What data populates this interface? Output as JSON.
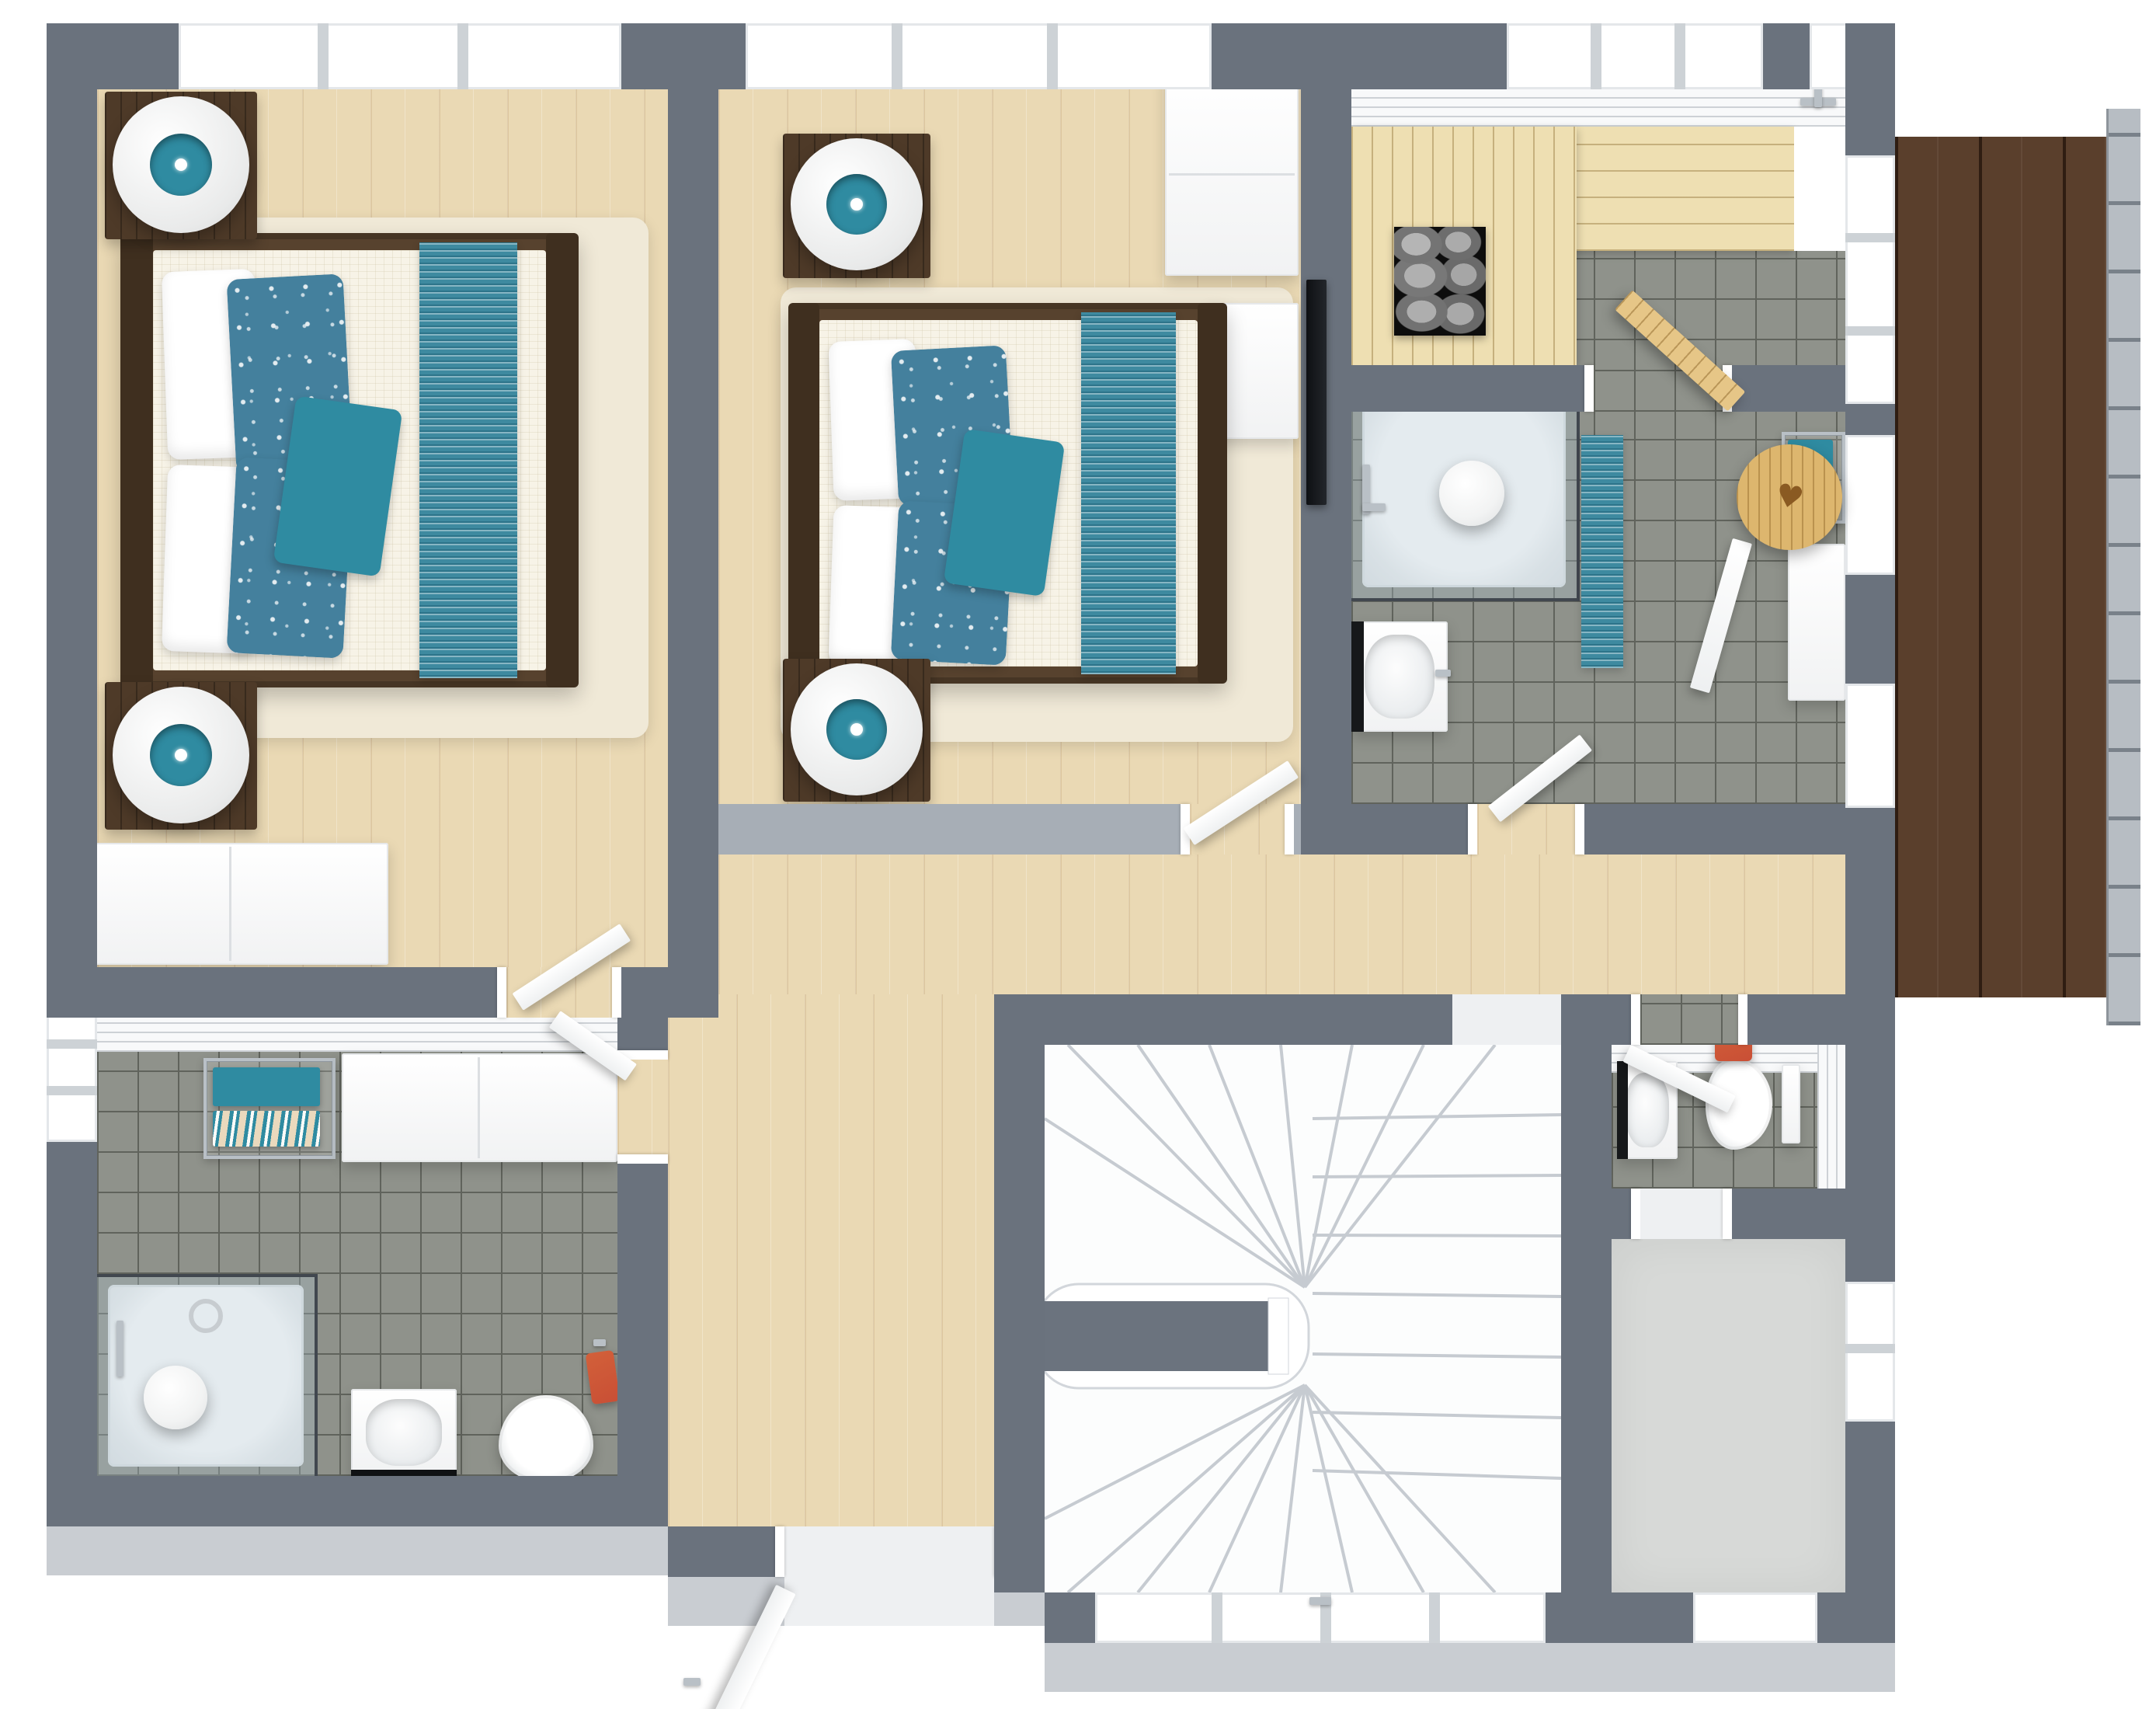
{
  "rooms": [
    {
      "id": "bedroom-1",
      "name": "Bedroom 1"
    },
    {
      "id": "bedroom-2",
      "name": "Bedroom 2"
    },
    {
      "id": "hallway",
      "name": "Hallway / Landing"
    },
    {
      "id": "bathroom-left",
      "name": "Bathroom with shower and laundry"
    },
    {
      "id": "sauna",
      "name": "Sauna"
    },
    {
      "id": "bathroom-top",
      "name": "Shower bathroom"
    },
    {
      "id": "wc",
      "name": "WC"
    },
    {
      "id": "storage",
      "name": "Walk-in closet / Storage"
    },
    {
      "id": "staircase",
      "name": "Winder staircase"
    },
    {
      "id": "balcony",
      "name": "Balcony terrace"
    }
  ],
  "furniture": {
    "double_bed": "Double bed with white duvet and teal runner",
    "mattress": "Mattress with white duvet",
    "pillow": "White pillow",
    "floral_pillow": "Teal floral pillow",
    "accent_cushion": "Teal accent cushion",
    "bed_runner": "Striped teal bed runner",
    "nightstand": "Dark wood nightstand",
    "table_lamp": "Round white table lamp",
    "area_rug": "Cream area rug",
    "dresser": "White dresser",
    "wardrobe": "White wardrobe",
    "tv": "Wall-mounted TV",
    "interior_door": "Open interior door",
    "entry_door": "Open door",
    "sauna_bench": "Sauna wood bench",
    "sauna_heater": "Sauna heater with stones",
    "sauna_door": "Wooden sauna door (open)",
    "wooden_stool": "Round wooden stool",
    "shower": "Walk-in shower with glass enclosure",
    "shower_tray": "White shower tray",
    "shower_light": "Ceiling globe light",
    "bath_mat": "Teal bath mat",
    "washbasin": "Washbasin",
    "vanity": "White vanity cabinet",
    "towel_rack": "Chrome towel rack",
    "teal_towel": "Teal towel",
    "patterned_towel": "Patterned towel",
    "red_towel": "Red towel",
    "orange_towel": "Orange towel",
    "toilet": "Toilet",
    "cistern": "Toilet cistern",
    "laundry_counter": "White counter cabinet",
    "window": "Window",
    "staircase": "White winder staircase",
    "landing_wall": "Staircase landing divider",
    "deck": "Dark wood deck boards",
    "railing": "Balcony railing",
    "wall": "Wall",
    "wall_panel": "White wall paneling",
    "threshold": "Door threshold",
    "faucet": "Chrome faucet",
    "towel_hook": "Chrome hook"
  },
  "colors": {
    "wall": "#6a727d",
    "wallFace": "#a7aeb6",
    "wallOuter": "#c9cdd2",
    "wood": "#ead9b4",
    "woodLine": "#c9a97a",
    "tile": "#8f928b",
    "tileLine": "#60635c",
    "deck": "#5a3f2c",
    "deckLine": "#2f1d12",
    "bench": "#eedfb2",
    "benchLine": "#bb9c66",
    "teal": "#2f8ba1",
    "tealDark": "#23768c",
    "floral": "#44809d",
    "runner": "#3e8aa0",
    "rug": "#f0e9d7",
    "mattress": "#f7f3e7",
    "frame": "#57422e",
    "frameDark": "#3f2f1f",
    "nightstand": "#4e3a28",
    "stone": "#a8a8a8",
    "stoneBg": "#0d0d0d",
    "orange": "#d2603a",
    "red": "#c94f35",
    "chrome": "#b9c0c6",
    "glass": "rgba(172,192,205,0.32)",
    "glassEdge": "#41474f",
    "white": "#ffffff",
    "panel": "#f8f9fa",
    "carpet": "#d7d9d7",
    "stool": "#ddb66e",
    "saunaDoor": "#e6c687"
  },
  "icons": {
    "heart": "♥"
  }
}
